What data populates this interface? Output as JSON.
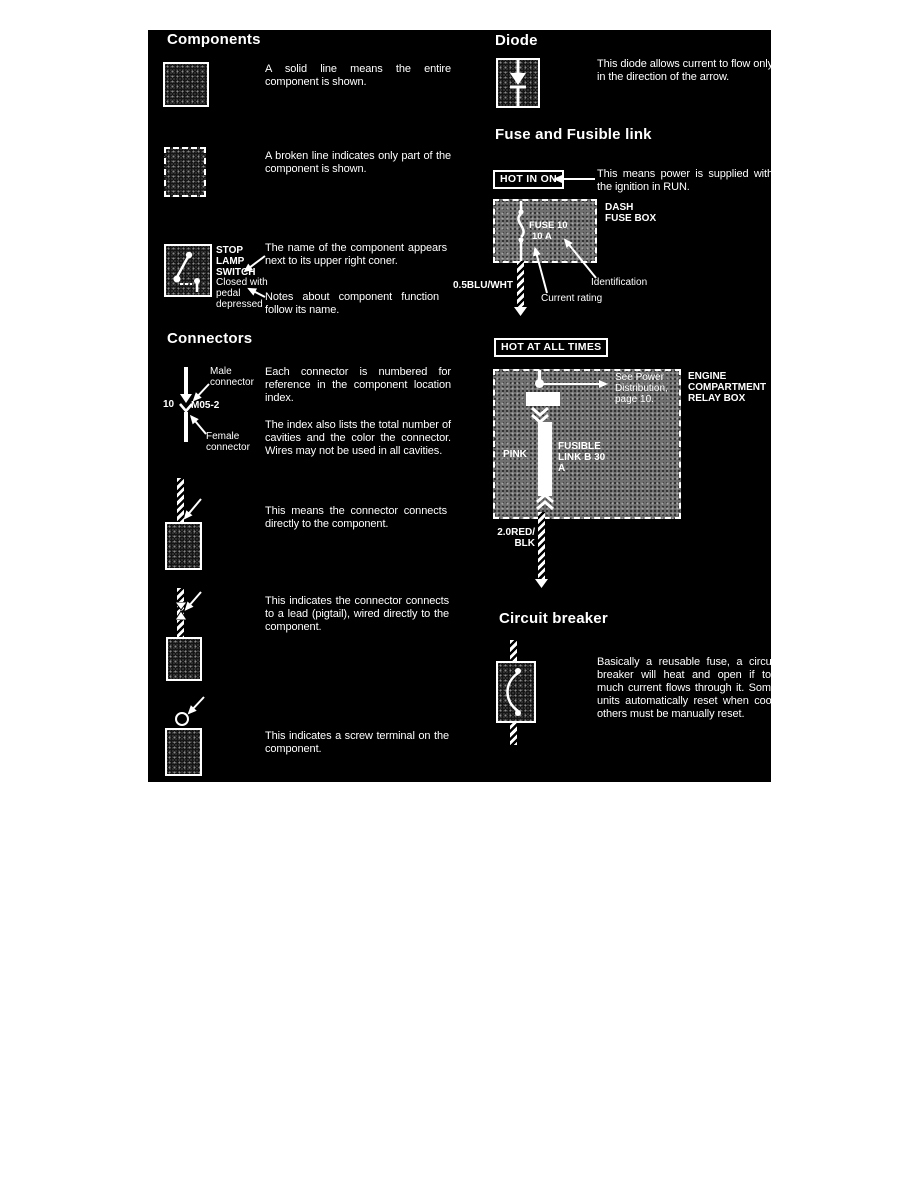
{
  "colors": {
    "panel_bg": "#000000",
    "page_bg": "#ffffff",
    "text": "#ffffff"
  },
  "headings": {
    "components": "Components",
    "connectors": "Connectors",
    "diode": "Diode",
    "fuse": "Fuse and Fusible link",
    "breaker": "Circuit breaker"
  },
  "components": {
    "solid_text": "A solid line means the entire component is shown.",
    "broken_text": "A broken line indicates only part of the component is shown.",
    "stop_lamp_name": "STOP LAMP SWITCH",
    "stop_lamp_note": "Closed with pedal depressed",
    "name_text": "The name of the component appears next to its upper right coner.",
    "notes_text": "Notes about component function follow its name."
  },
  "connectors": {
    "male_label": "Male connector",
    "female_label": "Female connector",
    "cavity_count": "10",
    "connector_id": "M05-2",
    "numbered_text": "Each connector is numbered for reference in the component location index.",
    "index_text": "The index also lists the total number of cavities and the color the connector. Wires may not be used in all cavities.",
    "direct_text": "This means the connector connects directly to the component.",
    "pigtail_text": "This indicates the connector connects to a lead (pigtail), wired directly to the component.",
    "screw_text": "This indicates a screw terminal on the component."
  },
  "diode": {
    "text": "This diode allows current to flow only in the direction of the arrow."
  },
  "fuse": {
    "hot_in_on": "HOT IN ON",
    "supplied_text": "This means power is supplied with the ignition in RUN.",
    "box_label": "DASH FUSE BOX",
    "fuse_id": "FUSE 10",
    "rating": "10 A",
    "wire_label": "0.5BLU/WHT",
    "identification": "Identification",
    "current_rating": "Current rating"
  },
  "relay": {
    "hot_at_all_times": "HOT AT ALL TIMES",
    "box_label": "ENGINE COMPARTMENT RELAY BOX",
    "see_power": "See Power Distribution, page 10.",
    "pink": "PINK",
    "fusible_link": "FUSIBLE LINK B 30 A",
    "wire_label_line1": "2.0RED/",
    "wire_label_line2": "BLK"
  },
  "breaker": {
    "text": "Basically a reusable fuse, a circuit breaker will heat and open if too much current flows through it. Some units automatically reset when cool, others must be manually reset."
  }
}
